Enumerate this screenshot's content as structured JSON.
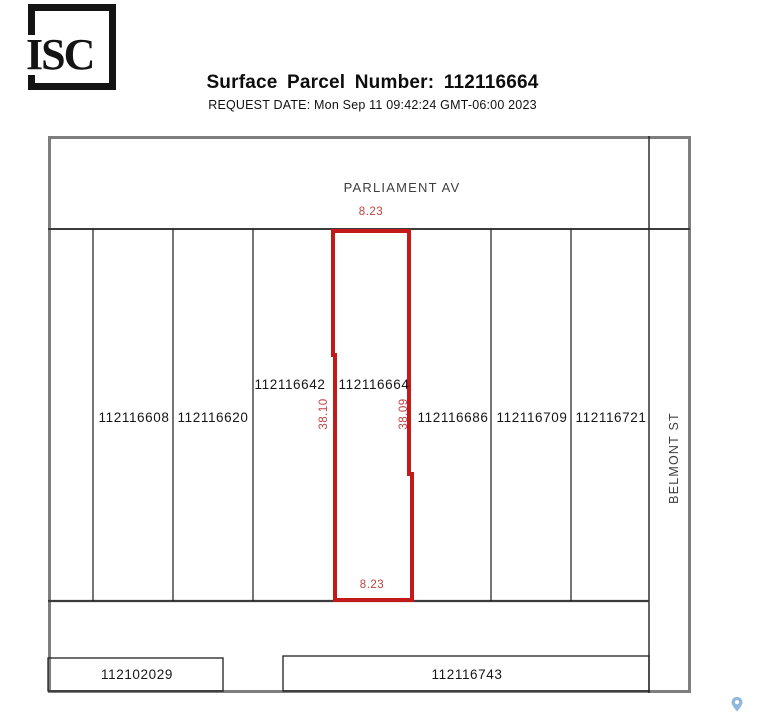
{
  "page": {
    "logo_text": "ISC",
    "title": "Surface Parcel Number: 112116664",
    "request_date": "REQUEST DATE: Mon Sep 11 09:42:24 GMT-06:00 2023"
  },
  "map": {
    "streets": {
      "top": "PARLIAMENT AV",
      "right": "BELMONT ST"
    },
    "parcels_row": [
      "112116608",
      "112116620",
      "112116642",
      "112116664",
      "112116686",
      "112116709",
      "112116721"
    ],
    "parcels_bottom": [
      "112102029",
      "112116743"
    ],
    "highlight_parcel": {
      "number": "112116664",
      "outline_color": "#c41919",
      "dimension_text_color": "#c14343",
      "dimensions": {
        "top": "8.23",
        "bottom": "8.23",
        "left": "38.10",
        "right": "38.09"
      }
    },
    "colors": {
      "outer_border": "#7e7e7e",
      "street_line": "#3c3c3c",
      "parcel_line": "#1a1a1a",
      "pin_blue": "#8fb8dc"
    }
  }
}
